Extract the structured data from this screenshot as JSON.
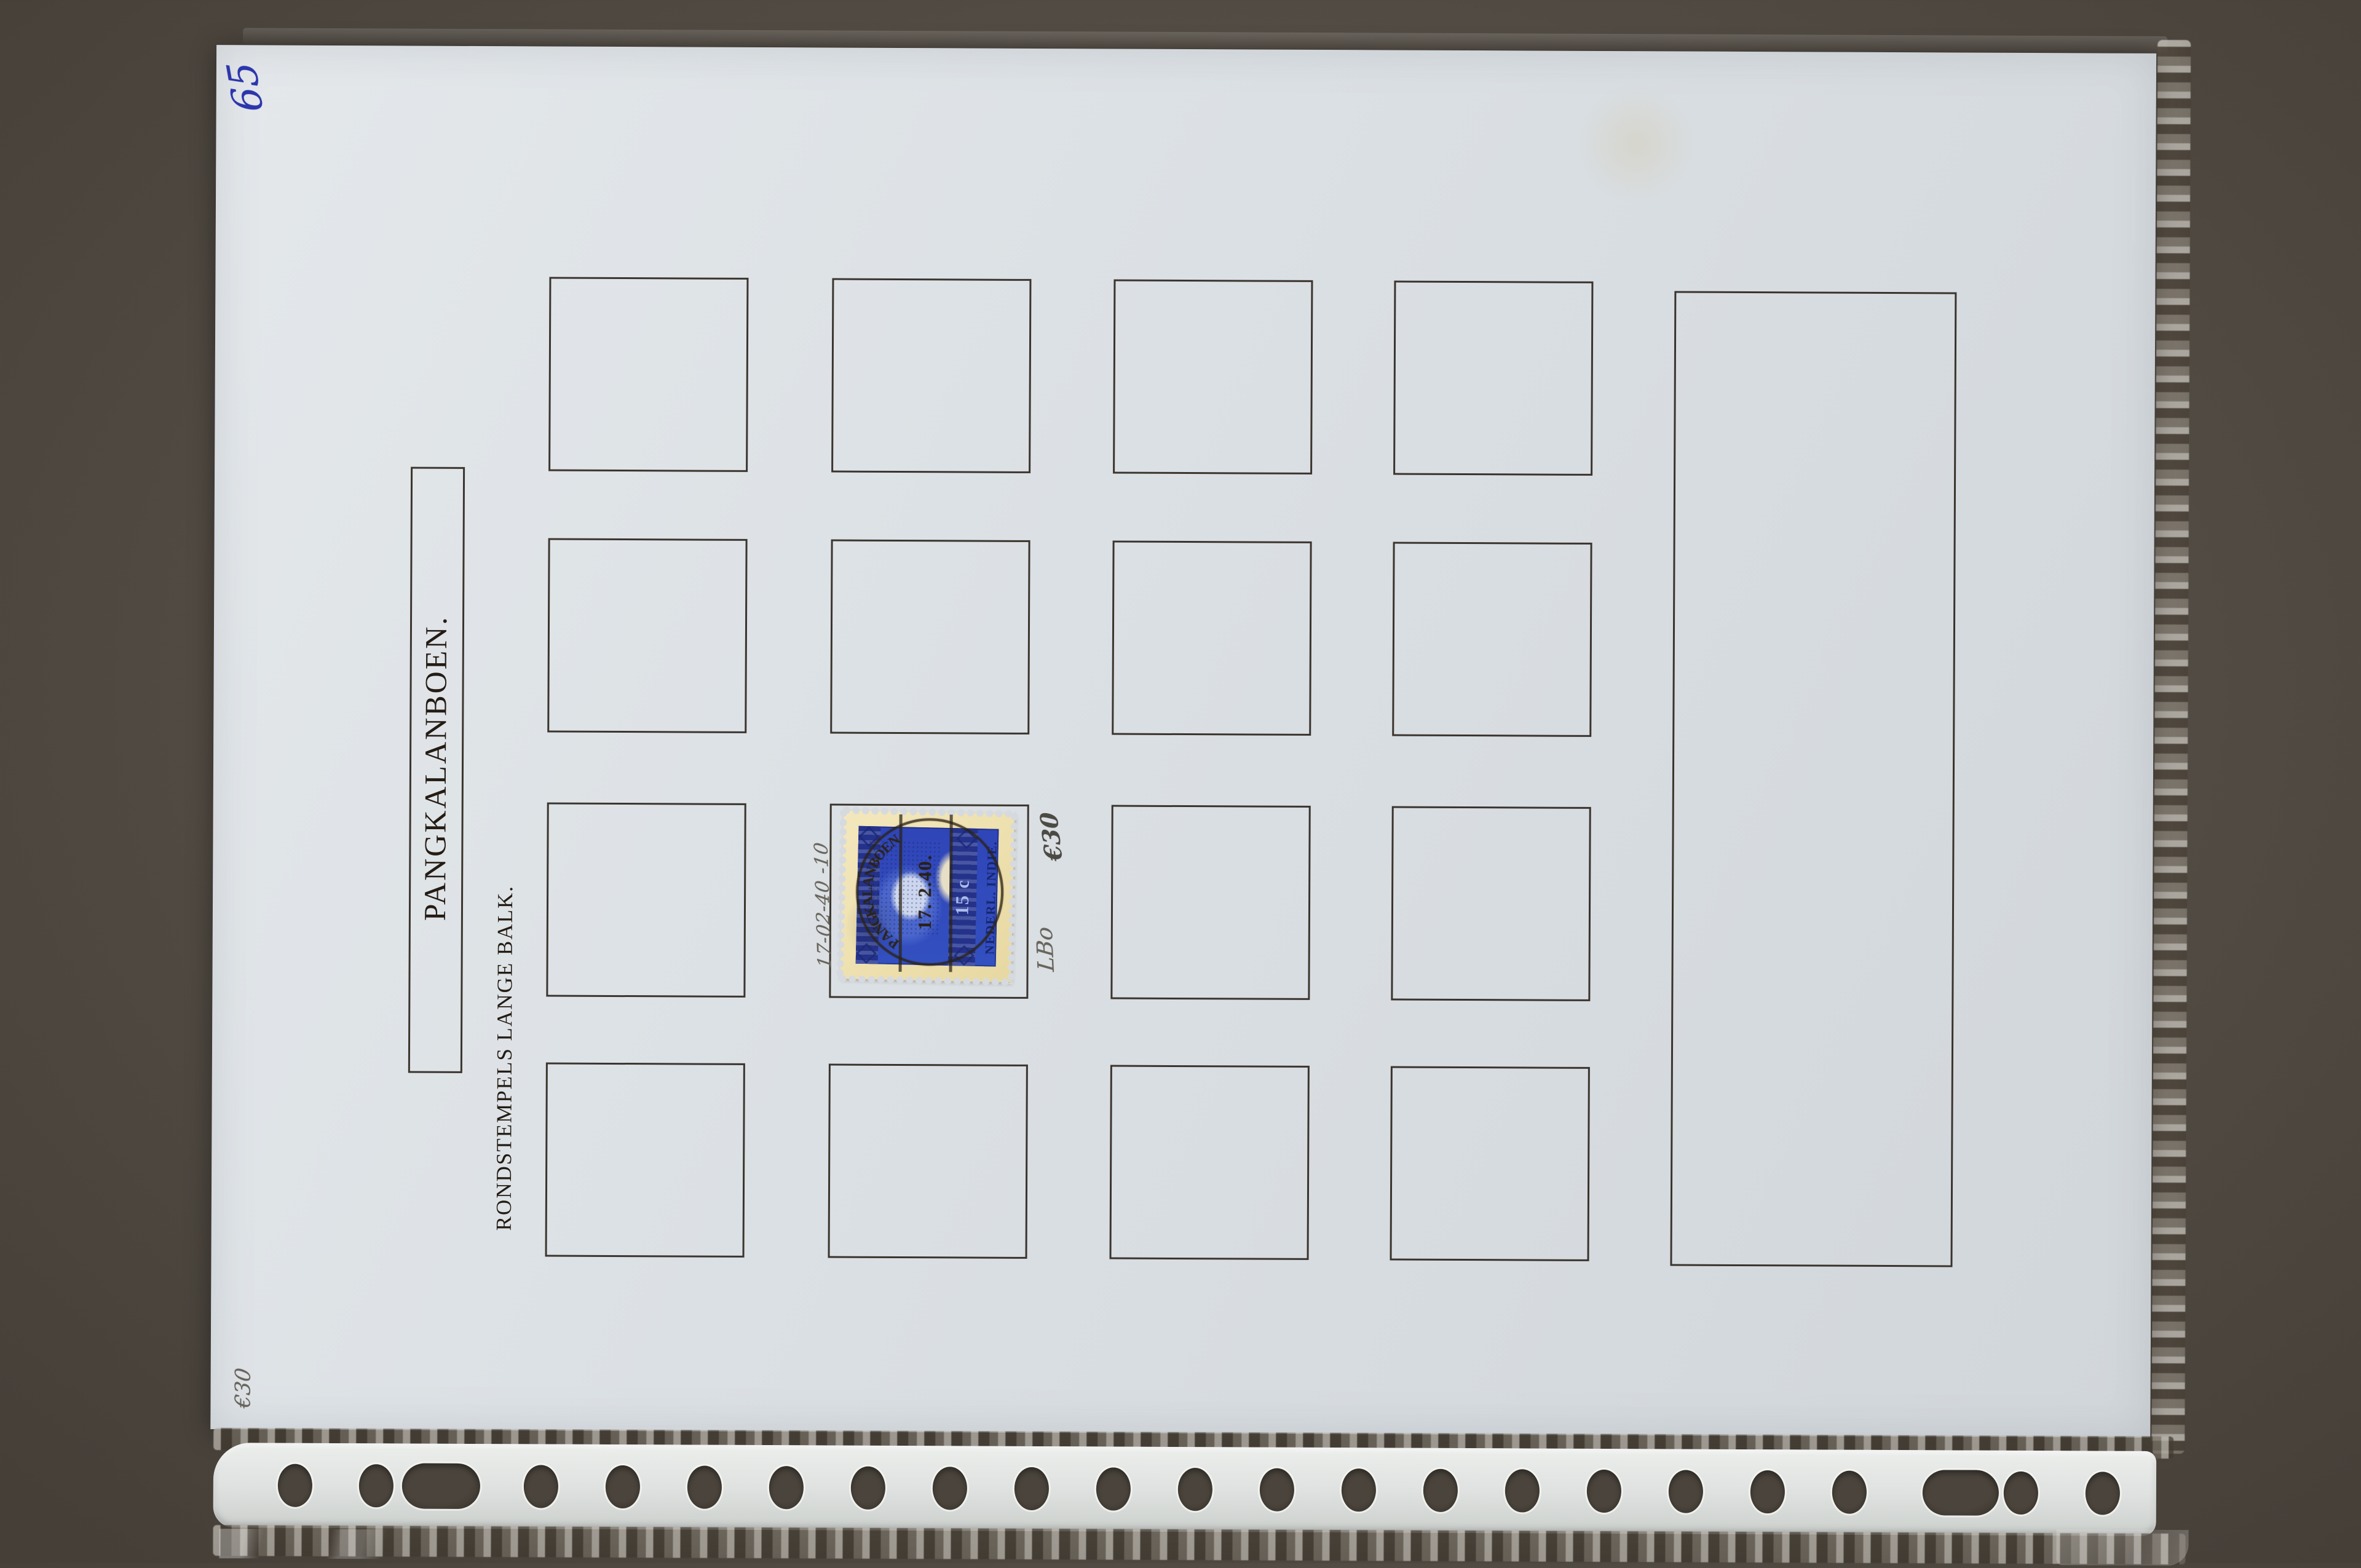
{
  "page": {
    "title": "PANGKALANBOEN.",
    "subtitle": "RONDSTEMPELS LANGE BALK."
  },
  "handwriting": {
    "corner_number": "65",
    "date_note": "17-02-40 -10",
    "value_note_stamp": "€30",
    "code_note": "LBo",
    "corner_value_note": "€30"
  },
  "stamp": {
    "country": "NEDERL. INDIE.",
    "value": "15 c",
    "cancel_town": "PANGKALANBOEN",
    "cancel_date": "17. 2.40."
  },
  "colors": {
    "background": "#564f47",
    "page": "#dbe0e4",
    "box_border": "#241c14",
    "ink_blue": "#2c36ac",
    "pencil": "#67645b",
    "stamp_blue": "#2f45b8",
    "stamp_cream": "#eee0ae",
    "postmark": "#2b2214"
  }
}
